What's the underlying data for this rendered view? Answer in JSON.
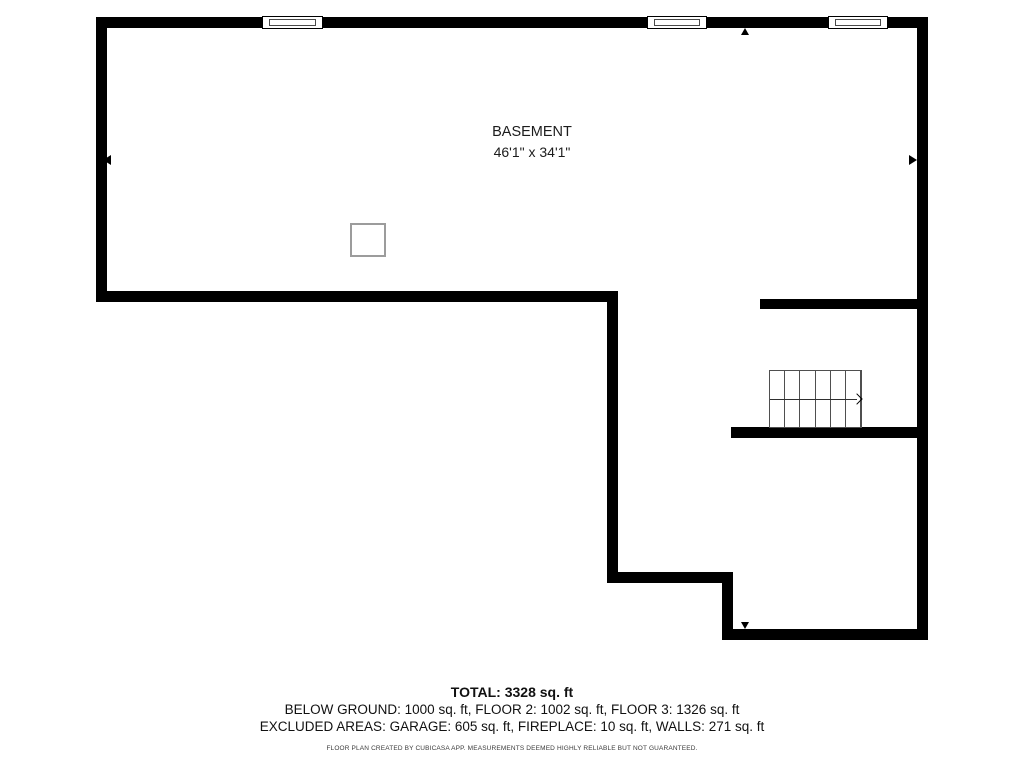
{
  "labels": {
    "room_name": "BASEMENT",
    "room_dims": "46'1\" x 34'1\""
  },
  "summary": {
    "total": "TOTAL: 3328 sq. ft",
    "floors": "BELOW GROUND: 1000 sq. ft, FLOOR 2: 1002 sq. ft, FLOOR 3: 1326 sq. ft",
    "excluded": "EXCLUDED AREAS: GARAGE: 605 sq. ft, FIREPLACE: 10 sq. ft, WALLS: 271 sq. ft"
  },
  "footer": {
    "disclaimer": "FLOOR PLAN CREATED BY CUBICASA APP. MEASUREMENTS DEEMED HIGHLY RELIABLE BUT NOT GUARANTEED."
  },
  "colors": {
    "wall": "#000000",
    "background": "#ffffff",
    "stair_lines": "#4f4f4f",
    "column_border": "#9c9c9c",
    "text": "#1a1a1a"
  },
  "plan": {
    "walls": [
      {
        "name": "top-wall",
        "x": 96,
        "y": 17,
        "w": 832,
        "h": 11
      },
      {
        "name": "left-wall",
        "x": 96,
        "y": 17,
        "w": 11,
        "h": 285
      },
      {
        "name": "right-wall",
        "x": 917,
        "y": 17,
        "w": 11,
        "h": 623
      },
      {
        "name": "basement-south-wall",
        "x": 96,
        "y": 291,
        "w": 522,
        "h": 11
      },
      {
        "name": "mid-vertical-wall",
        "x": 607,
        "y": 291,
        "w": 11,
        "h": 291
      },
      {
        "name": "lower-horizontal-wall",
        "x": 607,
        "y": 572,
        "w": 126,
        "h": 11
      },
      {
        "name": "lower-vertical-wall",
        "x": 722,
        "y": 572,
        "w": 11,
        "h": 68
      },
      {
        "name": "bottom-wall",
        "x": 722,
        "y": 629,
        "w": 206,
        "h": 11
      },
      {
        "name": "stair-room-north-wall",
        "x": 760,
        "y": 299,
        "w": 157,
        "h": 10
      },
      {
        "name": "stair-room-south-wall",
        "x": 731,
        "y": 427,
        "w": 186,
        "h": 11
      }
    ],
    "windows": [
      {
        "name": "window-1",
        "x": 262,
        "w": 61
      },
      {
        "name": "window-2",
        "x": 647,
        "w": 60
      },
      {
        "name": "window-3",
        "x": 828,
        "w": 60
      }
    ],
    "column": {
      "name": "support-column",
      "x": 350,
      "y": 223,
      "w": 36,
      "h": 34
    },
    "stairs": {
      "name": "staircase",
      "x": 769,
      "y": 370,
      "w": 93,
      "h": 58,
      "steps": 6
    },
    "markers": [
      {
        "name": "west-direction-arrow-icon",
        "dir": "left",
        "x": 103,
        "y": 155
      },
      {
        "name": "east-direction-arrow-icon",
        "dir": "right",
        "x": 909,
        "y": 155
      },
      {
        "name": "north-direction-arrow-icon",
        "dir": "up",
        "x": 741,
        "y": 28
      },
      {
        "name": "south-direction-arrow-icon",
        "dir": "down",
        "x": 741,
        "y": 622
      }
    ]
  }
}
